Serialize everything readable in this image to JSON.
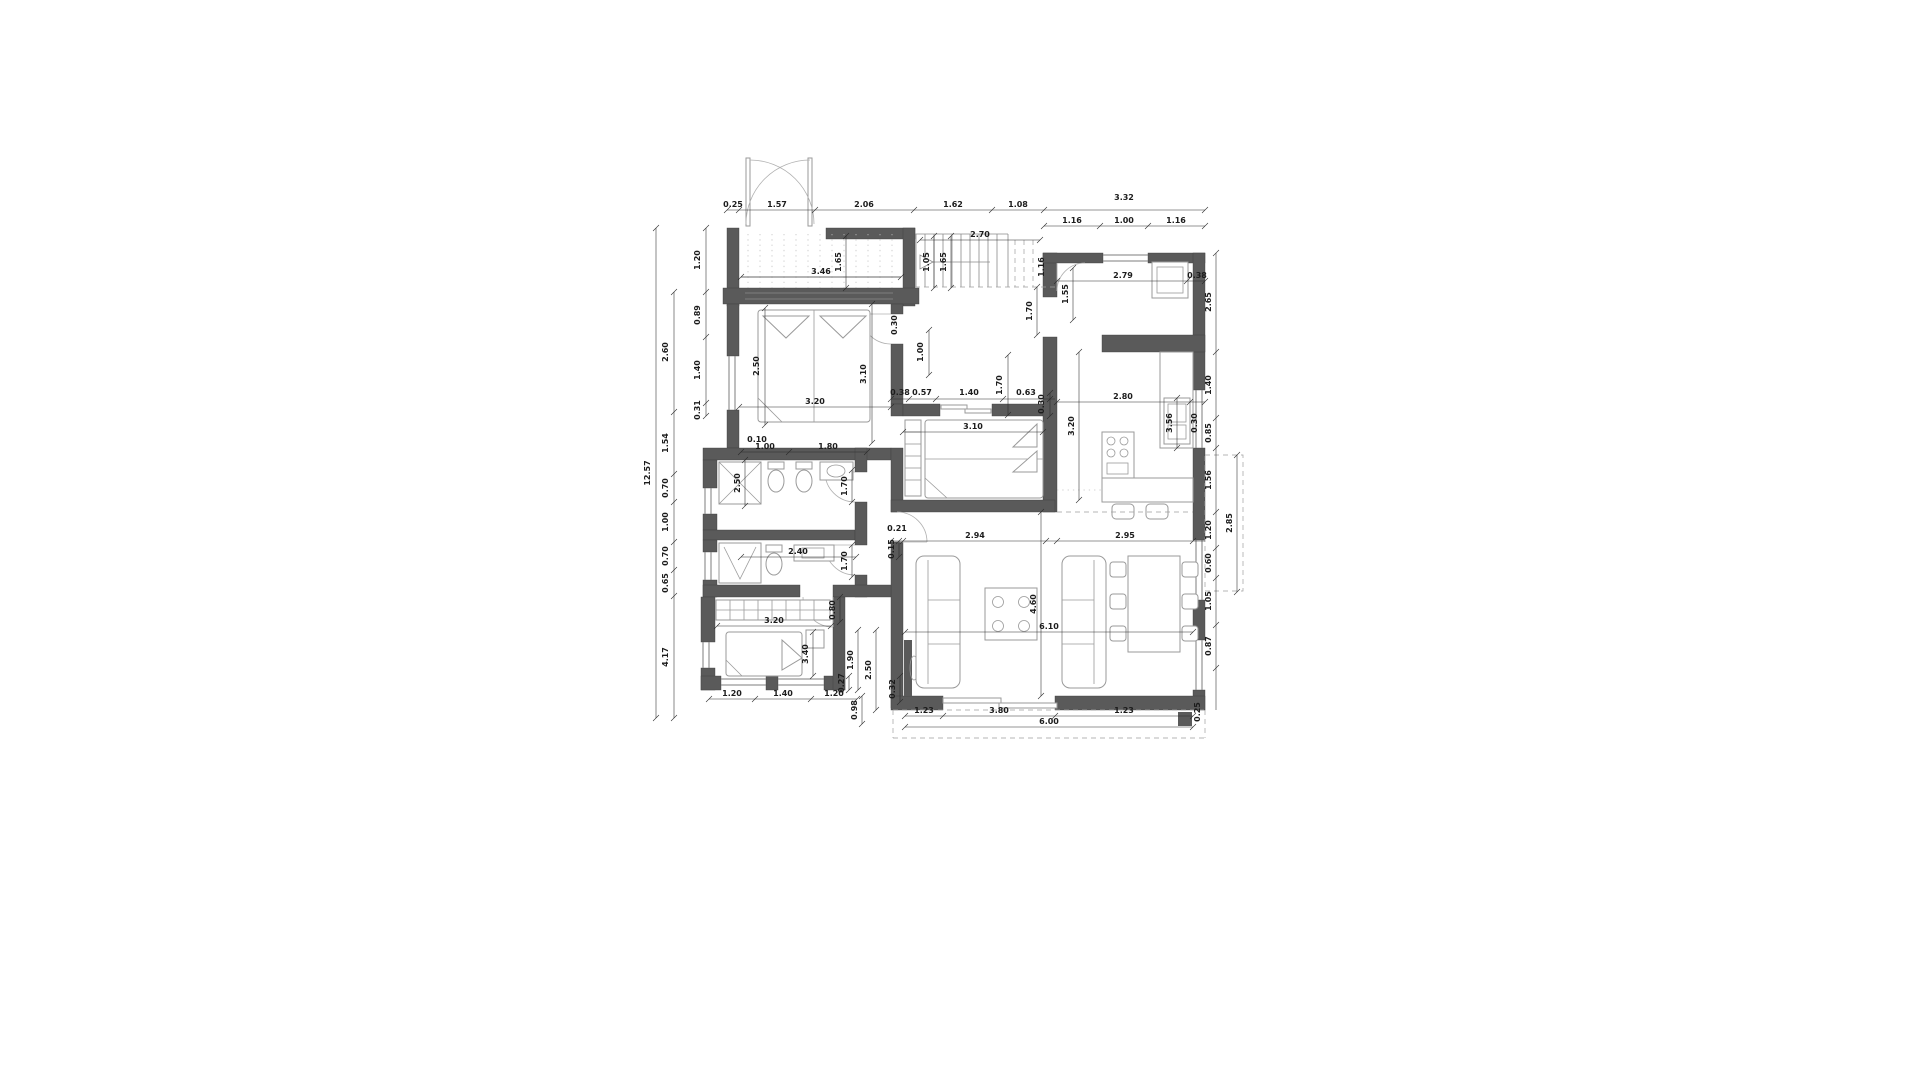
{
  "drawing": {
    "type": "architectural-floor-plan",
    "colors": {
      "wall": "#5a5a5a",
      "furniture_line": "#9a9a9a",
      "dimension": "#1c1c1c",
      "background": "#ffffff"
    },
    "dimension_labels": [
      {
        "t": "0.25",
        "x": 733,
        "y": 207,
        "r": 0
      },
      {
        "t": "1.57",
        "x": 777,
        "y": 207,
        "r": 0
      },
      {
        "t": "2.06",
        "x": 864,
        "y": 207,
        "r": 0
      },
      {
        "t": "1.62",
        "x": 953,
        "y": 207,
        "r": 0
      },
      {
        "t": "1.08",
        "x": 1018,
        "y": 207,
        "r": 0
      },
      {
        "t": "3.32",
        "x": 1124,
        "y": 200,
        "r": 0
      },
      {
        "t": "1.16",
        "x": 1072,
        "y": 223,
        "r": 0
      },
      {
        "t": "1.00",
        "x": 1124,
        "y": 223,
        "r": 0
      },
      {
        "t": "1.16",
        "x": 1176,
        "y": 223,
        "r": 0
      },
      {
        "t": "2.70",
        "x": 980,
        "y": 237,
        "r": 0
      },
      {
        "t": "12.57",
        "x": 650,
        "y": 473,
        "r": 1
      },
      {
        "t": "2.60",
        "x": 668,
        "y": 352,
        "r": 1
      },
      {
        "t": "1.54",
        "x": 668,
        "y": 443,
        "r": 1
      },
      {
        "t": "0.70",
        "x": 668,
        "y": 488,
        "r": 1
      },
      {
        "t": "1.00",
        "x": 668,
        "y": 522,
        "r": 1
      },
      {
        "t": "0.70",
        "x": 668,
        "y": 556,
        "r": 1
      },
      {
        "t": "0.65",
        "x": 668,
        "y": 583,
        "r": 1
      },
      {
        "t": "4.17",
        "x": 668,
        "y": 657,
        "r": 1
      },
      {
        "t": "1.20",
        "x": 700,
        "y": 260,
        "r": 1
      },
      {
        "t": "0.89",
        "x": 700,
        "y": 315,
        "r": 1
      },
      {
        "t": "1.40",
        "x": 700,
        "y": 370,
        "r": 1
      },
      {
        "t": "0.31",
        "x": 700,
        "y": 410,
        "r": 1
      },
      {
        "t": "3.46",
        "x": 821,
        "y": 274,
        "r": 0
      },
      {
        "t": "1.65",
        "x": 841,
        "y": 262,
        "r": 1
      },
      {
        "t": "1.05",
        "x": 929,
        "y": 262,
        "r": 1
      },
      {
        "t": "1.65",
        "x": 946,
        "y": 262,
        "r": 1
      },
      {
        "t": "1.00",
        "x": 923,
        "y": 352,
        "r": 1
      },
      {
        "t": "0.30",
        "x": 897,
        "y": 325,
        "r": 1
      },
      {
        "t": "0.38",
        "x": 900,
        "y": 395,
        "r": 0
      },
      {
        "t": "0.57",
        "x": 922,
        "y": 395,
        "r": 0
      },
      {
        "t": "1.40",
        "x": 969,
        "y": 395,
        "r": 0
      },
      {
        "t": "0.63",
        "x": 1026,
        "y": 395,
        "r": 0
      },
      {
        "t": "1.70",
        "x": 1002,
        "y": 385,
        "r": 1
      },
      {
        "t": "0.30",
        "x": 1044,
        "y": 404,
        "r": 1
      },
      {
        "t": "2.50",
        "x": 759,
        "y": 366,
        "r": 1
      },
      {
        "t": "3.10",
        "x": 866,
        "y": 374,
        "r": 1
      },
      {
        "t": "3.20",
        "x": 815,
        "y": 404,
        "r": 0
      },
      {
        "t": "3.10",
        "x": 973,
        "y": 429,
        "r": 0
      },
      {
        "t": "3.20",
        "x": 1074,
        "y": 426,
        "r": 1
      },
      {
        "t": "2.79",
        "x": 1123,
        "y": 278,
        "r": 0
      },
      {
        "t": "0.38",
        "x": 1197,
        "y": 278,
        "r": 0
      },
      {
        "t": "1.16",
        "x": 1044,
        "y": 267,
        "r": 1
      },
      {
        "t": "1.55",
        "x": 1068,
        "y": 294,
        "r": 1
      },
      {
        "t": "1.70",
        "x": 1032,
        "y": 311,
        "r": 1
      },
      {
        "t": "2.80",
        "x": 1123,
        "y": 399,
        "r": 0
      },
      {
        "t": "0.30",
        "x": 1197,
        "y": 423,
        "r": 1
      },
      {
        "t": "3.56",
        "x": 1172,
        "y": 423,
        "r": 1
      },
      {
        "t": "2.65",
        "x": 1211,
        "y": 302,
        "r": 1
      },
      {
        "t": "1.40",
        "x": 1211,
        "y": 385,
        "r": 1
      },
      {
        "t": "0.85",
        "x": 1211,
        "y": 433,
        "r": 1
      },
      {
        "t": "1.56",
        "x": 1211,
        "y": 480,
        "r": 1
      },
      {
        "t": "1.20",
        "x": 1211,
        "y": 530,
        "r": 1
      },
      {
        "t": "0.60",
        "x": 1211,
        "y": 563,
        "r": 1
      },
      {
        "t": "1.05",
        "x": 1211,
        "y": 601,
        "r": 1
      },
      {
        "t": "0.87",
        "x": 1211,
        "y": 646,
        "r": 1
      },
      {
        "t": "2.85",
        "x": 1232,
        "y": 523,
        "r": 1
      },
      {
        "t": "0.10",
        "x": 757,
        "y": 442,
        "r": 0
      },
      {
        "t": "1.00",
        "x": 765,
        "y": 449,
        "r": 0
      },
      {
        "t": "1.80",
        "x": 828,
        "y": 449,
        "r": 0
      },
      {
        "t": "2.50",
        "x": 740,
        "y": 483,
        "r": 1
      },
      {
        "t": "2.40",
        "x": 798,
        "y": 554,
        "r": 0
      },
      {
        "t": "1.70",
        "x": 847,
        "y": 486,
        "r": 1
      },
      {
        "t": "1.70",
        "x": 847,
        "y": 561,
        "r": 1
      },
      {
        "t": "0.21",
        "x": 897,
        "y": 531,
        "r": 0
      },
      {
        "t": "0.15",
        "x": 894,
        "y": 549,
        "r": 1
      },
      {
        "t": "2.94",
        "x": 975,
        "y": 538,
        "r": 0
      },
      {
        "t": "2.95",
        "x": 1125,
        "y": 538,
        "r": 0
      },
      {
        "t": "6.10",
        "x": 1049,
        "y": 629,
        "r": 0
      },
      {
        "t": "4.60",
        "x": 1036,
        "y": 604,
        "r": 1
      },
      {
        "t": "0.80",
        "x": 835,
        "y": 610,
        "r": 1
      },
      {
        "t": "3.20",
        "x": 774,
        "y": 623,
        "r": 0
      },
      {
        "t": "3.40",
        "x": 808,
        "y": 654,
        "r": 1
      },
      {
        "t": "0.27",
        "x": 844,
        "y": 683,
        "r": 1
      },
      {
        "t": "0.32",
        "x": 895,
        "y": 689,
        "r": 1
      },
      {
        "t": "1.20",
        "x": 732,
        "y": 696,
        "r": 0
      },
      {
        "t": "1.40",
        "x": 783,
        "y": 696,
        "r": 0
      },
      {
        "t": "1.20",
        "x": 834,
        "y": 696,
        "r": 0
      },
      {
        "t": "1.23",
        "x": 924,
        "y": 713,
        "r": 0
      },
      {
        "t": "3.80",
        "x": 999,
        "y": 713,
        "r": 0
      },
      {
        "t": "1.23",
        "x": 1124,
        "y": 713,
        "r": 0
      },
      {
        "t": "6.00",
        "x": 1049,
        "y": 724,
        "r": 0
      },
      {
        "t": "0.25",
        "x": 1200,
        "y": 712,
        "r": 1
      },
      {
        "t": "1.90",
        "x": 853,
        "y": 660,
        "r": 1
      },
      {
        "t": "2.50",
        "x": 871,
        "y": 670,
        "r": 1
      },
      {
        "t": "0.98",
        "x": 857,
        "y": 710,
        "r": 1
      }
    ]
  }
}
